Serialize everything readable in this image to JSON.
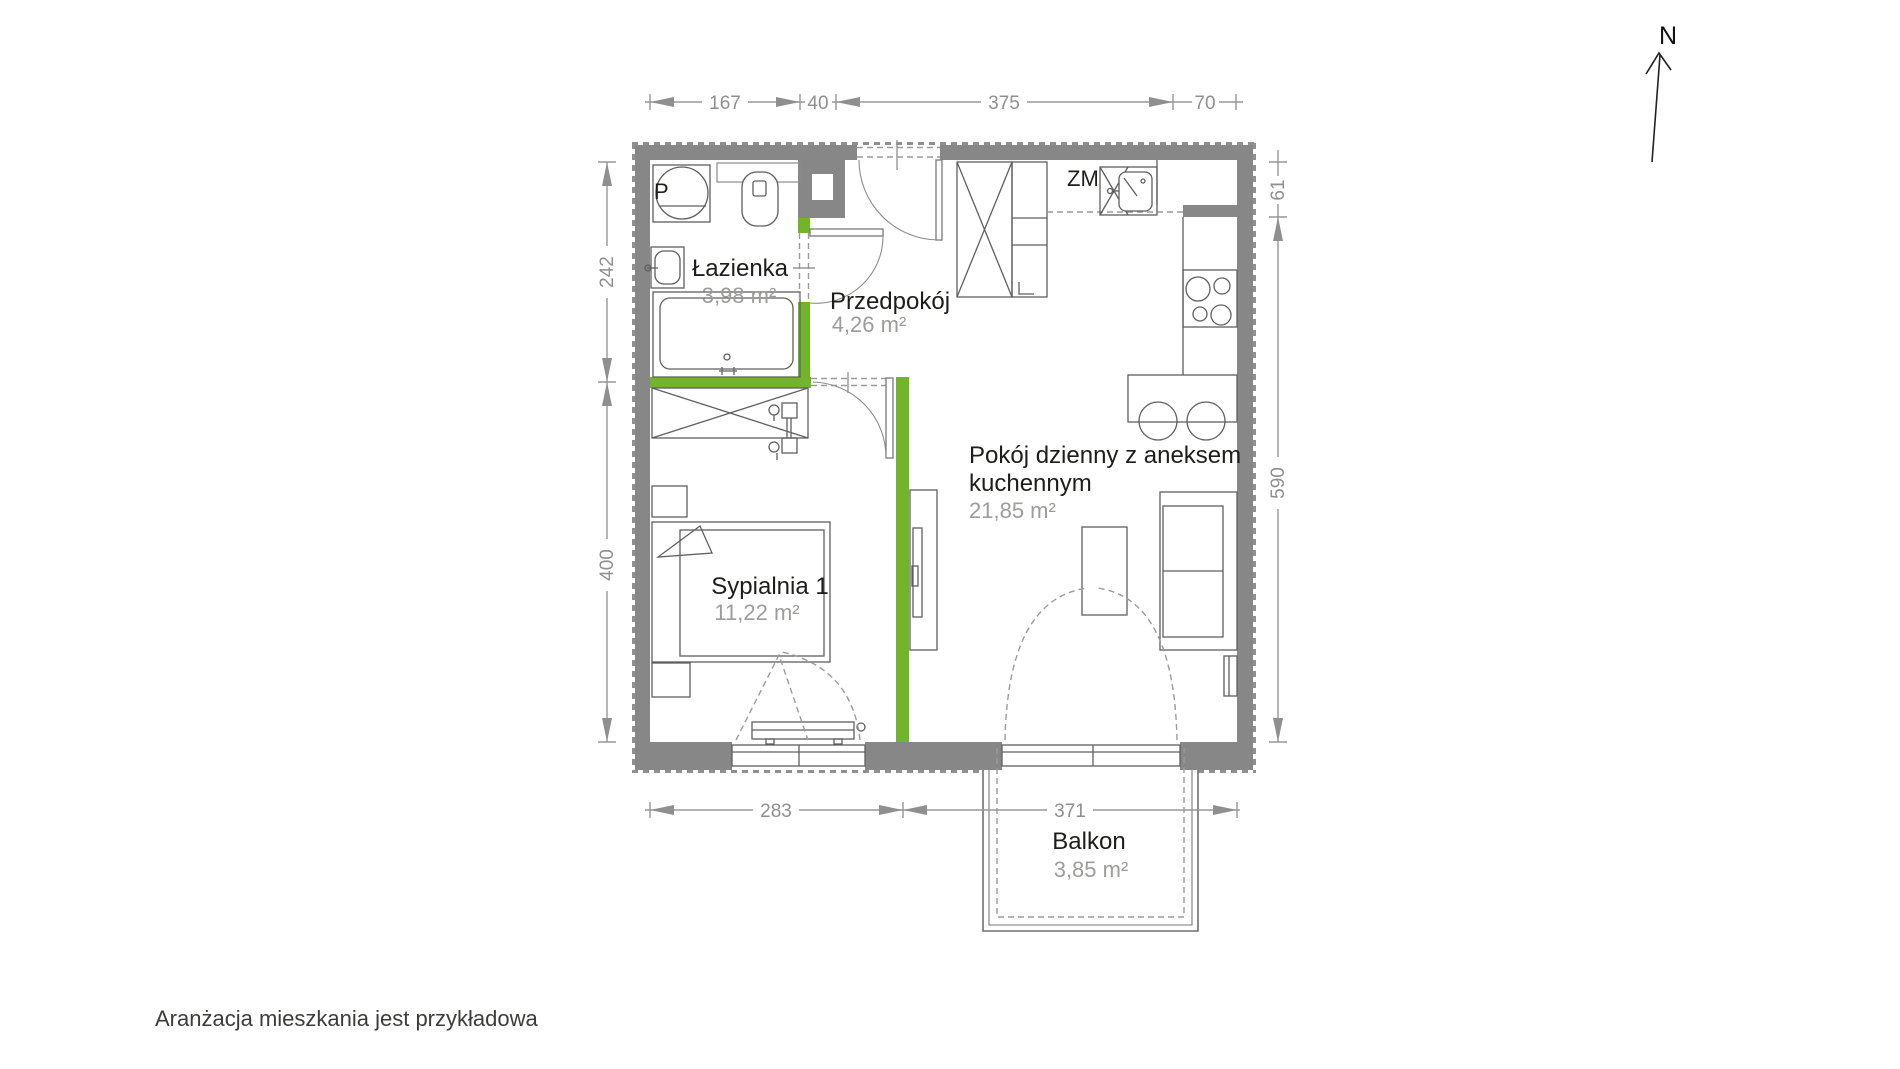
{
  "rooms": {
    "bathroom": {
      "name": "Łazienka",
      "area": "3,98 m²"
    },
    "hallway": {
      "name": "Przedpokój",
      "area": "4,26 m²"
    },
    "living": {
      "name_line1": "Pokój dzienny z aneksem",
      "name_line2": "kuchennym",
      "area": "21,85 m²"
    },
    "bedroom": {
      "name": "Sypialnia 1",
      "area": "11,22 m²"
    },
    "balcony": {
      "name": "Balkon",
      "area": "3,85 m²"
    }
  },
  "fixtures": {
    "washer_label": "P",
    "dishwasher_label": "ZM"
  },
  "dimensions": {
    "top": [
      "167",
      "40",
      "375",
      "70"
    ],
    "left": [
      "242",
      "400"
    ],
    "right": [
      "61",
      "590"
    ],
    "bottom": [
      "283",
      "371"
    ]
  },
  "compass": {
    "label": "N"
  },
  "footer": {
    "disclaimer": "Aranżacja mieszkania jest przykładowa"
  },
  "colors": {
    "wall": "#878787",
    "accent_green": "#72b52a",
    "dimension_gray": "#979797",
    "label_black": "#1d1d1b",
    "area_gray": "#9c9c9b"
  }
}
